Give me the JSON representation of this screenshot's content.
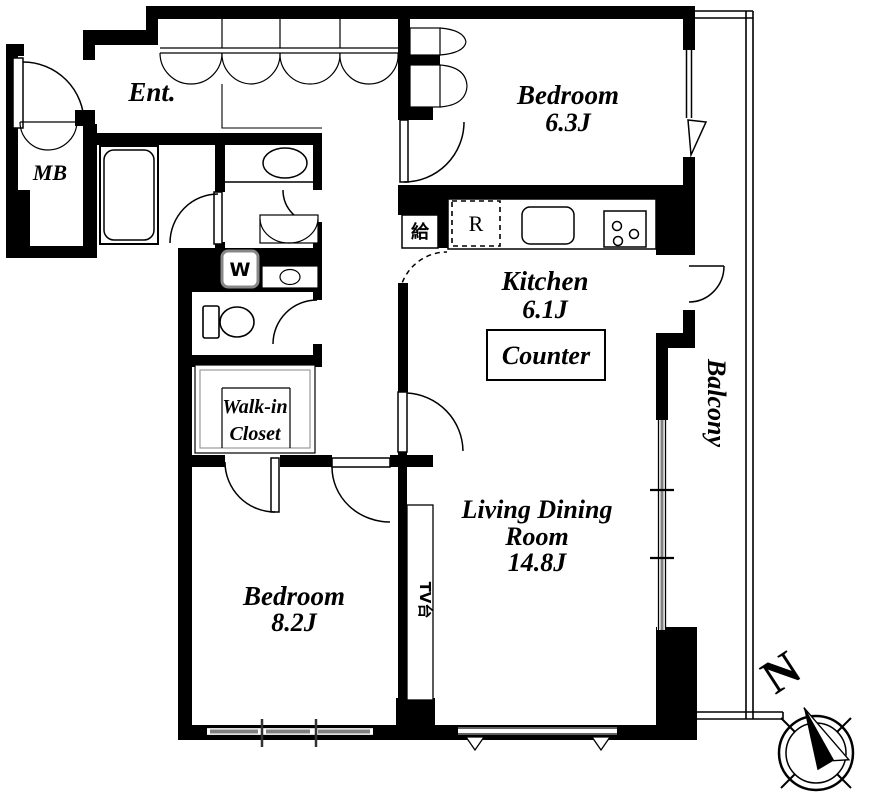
{
  "plan": {
    "rooms": {
      "entrance": {
        "label": "Ent."
      },
      "meter_box": {
        "label": "MB"
      },
      "bedroom_top": {
        "label": "Bedroom",
        "size": "6.3J"
      },
      "kitchen": {
        "label": "Kitchen",
        "size": "6.1J"
      },
      "counter": {
        "label": "Counter"
      },
      "living_dining": {
        "line1": "Living Dining",
        "line2": "Room",
        "size": "14.8J"
      },
      "bedroom_bottom": {
        "label": "Bedroom",
        "size": "8.2J"
      },
      "walk_in_closet": {
        "line1": "Walk-in",
        "line2": "Closet"
      },
      "balcony": {
        "label": "Balcony"
      }
    },
    "fixtures": {
      "washer": {
        "label": "W"
      },
      "refrigerator": {
        "label": "R"
      },
      "water_supply": {
        "label": "給"
      },
      "tv_stand": {
        "label": "TV台"
      }
    },
    "compass": {
      "north_label": "N"
    },
    "colors": {
      "wall": "#000000",
      "background": "#ffffff",
      "slider_gray": "#808080"
    }
  }
}
